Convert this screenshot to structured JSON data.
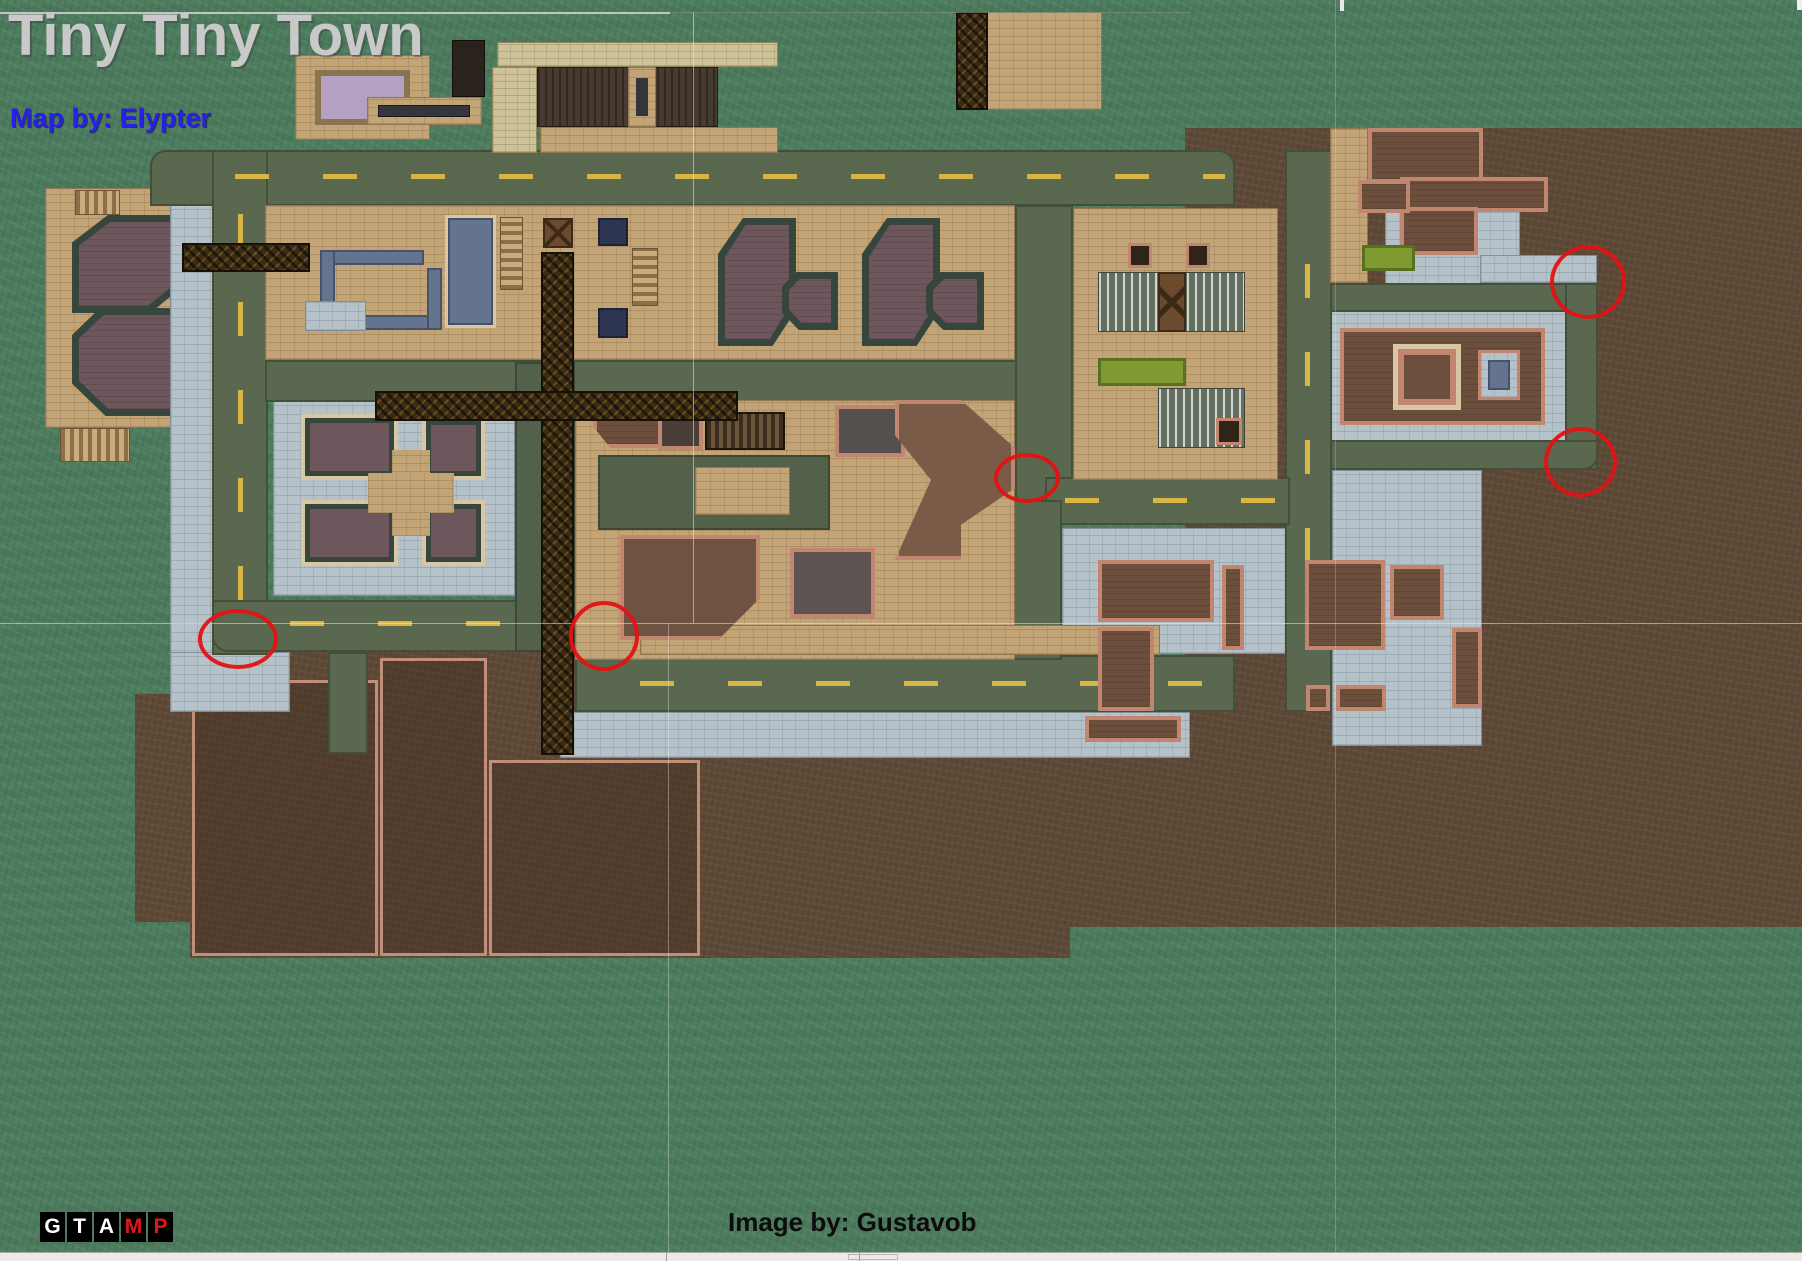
{
  "header": {
    "title": "Tiny Tiny Town",
    "map_by": "Map by: Elypter"
  },
  "footer": {
    "image_by": "Image by: Gustavob",
    "logo": {
      "name": "GTAMP",
      "tiles": [
        {
          "letter": "G",
          "color": "#ffffff"
        },
        {
          "letter": "T",
          "color": "#ffffff"
        },
        {
          "letter": "A",
          "color": "#ffffff"
        },
        {
          "letter": "M",
          "color": "#e01818"
        },
        {
          "letter": "P",
          "color": "#e01818"
        }
      ]
    }
  },
  "map": {
    "colors": {
      "grass": "#4e7d5f",
      "dirt": "#5e4937",
      "road": "#5a6850",
      "dash": "#d9b544",
      "pavement": "#b5c2c9",
      "plaza": "#c2a477",
      "slate": "#64748c",
      "lawn": "#7f9a31",
      "marker": "#e41212",
      "credit": "#2a1fe6"
    },
    "markers": [
      {
        "label": "circle-top-right",
        "x": 1550,
        "y": 245,
        "w": 76,
        "h": 74
      },
      {
        "label": "circle-mid-right",
        "x": 1544,
        "y": 427,
        "w": 73,
        "h": 70
      },
      {
        "label": "circle-center",
        "x": 994,
        "y": 453,
        "w": 66,
        "h": 50
      },
      {
        "label": "circle-bottom-left",
        "x": 198,
        "y": 609,
        "w": 80,
        "h": 60
      },
      {
        "label": "circle-bottom-mid",
        "x": 569,
        "y": 601,
        "w": 70,
        "h": 70
      }
    ]
  }
}
